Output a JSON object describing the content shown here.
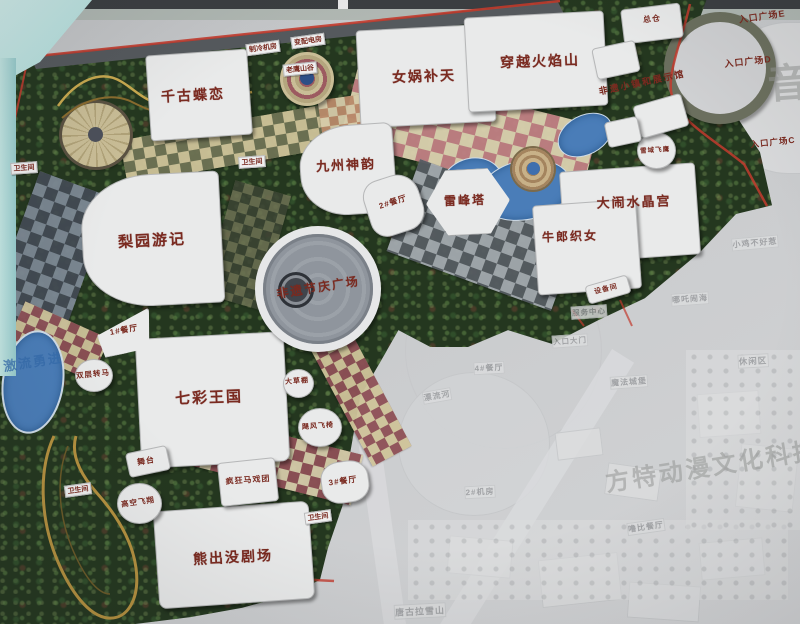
{
  "map": {
    "colors": {
      "label_red": "#7a2a20",
      "road_red": "#c23b2e",
      "water_blue": "#4a7db8",
      "sky_cyan": "#bfe4e1",
      "board_gray": "#c6c8ca",
      "ghost_text": "#96989b",
      "vegetation_green": "#24371f"
    },
    "labels": [
      {
        "name": "attraction-qiangu-dielian",
        "text": "千古蝶恋",
        "x": 193,
        "y": 95,
        "fs": 14,
        "rot": -3,
        "cls": "big"
      },
      {
        "name": "attraction-nvwa-butian",
        "text": "女娲补天",
        "x": 424,
        "y": 76,
        "fs": 14,
        "rot": -2,
        "cls": "big"
      },
      {
        "name": "attraction-chuanyue-huoyanshan",
        "text": "穿越火焰山",
        "x": 540,
        "y": 61,
        "fs": 14,
        "rot": -2,
        "cls": "big"
      },
      {
        "name": "attraction-jiuzhou-shenyun",
        "text": "九州神韵",
        "x": 346,
        "y": 164,
        "fs": 13,
        "rot": -3,
        "cls": "big"
      },
      {
        "name": "attraction-leifengta",
        "text": "雷峰塔",
        "x": 465,
        "y": 200,
        "fs": 12,
        "rot": -2,
        "cls": "big"
      },
      {
        "name": "attraction-danao-shuijinggong",
        "text": "大闹水晶宫",
        "x": 634,
        "y": 201,
        "fs": 13,
        "rot": -2,
        "cls": "big"
      },
      {
        "name": "attraction-niulang-zhinv",
        "text": "牛郎织女",
        "x": 570,
        "y": 236,
        "fs": 12,
        "rot": -2,
        "cls": "big"
      },
      {
        "name": "attraction-liyuan-youji",
        "text": "梨园游记",
        "x": 152,
        "y": 240,
        "fs": 15,
        "rot": -3,
        "cls": "big"
      },
      {
        "name": "plaza-feiyi-jieqing",
        "text": "非遗节庆广场",
        "x": 318,
        "y": 287,
        "fs": 12,
        "rot": -9,
        "cls": "big"
      },
      {
        "name": "attraction-qicai-wangguo",
        "text": "七彩王国",
        "x": 209,
        "y": 397,
        "fs": 15,
        "rot": -2,
        "cls": "big"
      },
      {
        "name": "attraction-xiongchumo-juchang",
        "text": "熊出没剧场",
        "x": 233,
        "y": 557,
        "fs": 14,
        "rot": -3,
        "cls": "big"
      },
      {
        "name": "attraction-fengkuang-maxituan",
        "text": "疯狂马戏团",
        "x": 248,
        "y": 480,
        "fs": 8,
        "rot": -4,
        "cls": "small"
      },
      {
        "name": "building-zongcang",
        "text": "总仓",
        "x": 652,
        "y": 19,
        "fs": 8,
        "rot": -6,
        "cls": "small"
      },
      {
        "name": "area-feiyi-town",
        "text": "非遗小镇和展示馆",
        "x": 642,
        "y": 82,
        "fs": 9,
        "rot": -12,
        "cls": "big"
      },
      {
        "name": "entrance-plaza-e",
        "text": "入口广场E",
        "x": 762,
        "y": 16,
        "fs": 9,
        "rot": -8,
        "cls": "small"
      },
      {
        "name": "entrance-plaza-d",
        "text": "入口广场D",
        "x": 748,
        "y": 61,
        "fs": 9,
        "rot": -6,
        "cls": "small"
      },
      {
        "name": "entrance-plaza-c",
        "text": "入口广场C",
        "x": 773,
        "y": 142,
        "fs": 8.5,
        "rot": -6,
        "cls": "small"
      },
      {
        "name": "restaurant-2",
        "text": "2#餐厅",
        "x": 393,
        "y": 202,
        "fs": 8,
        "rot": -18,
        "cls": "small"
      },
      {
        "name": "restaurant-1",
        "text": "1#餐厅",
        "x": 124,
        "y": 330,
        "fs": 8,
        "rot": -10,
        "cls": "small"
      },
      {
        "name": "restaurant-3",
        "text": "3#餐厅",
        "x": 343,
        "y": 481,
        "fs": 8,
        "rot": -8,
        "cls": "small"
      },
      {
        "name": "pavilion-dacaopeng",
        "text": "大草棚",
        "x": 297,
        "y": 381,
        "fs": 7,
        "rot": -4,
        "cls": "small"
      },
      {
        "name": "ride-jufeng-feiyi",
        "text": "飓风飞椅",
        "x": 318,
        "y": 426,
        "fs": 7,
        "rot": -4,
        "cls": "small"
      },
      {
        "name": "ride-gaokong-feixiang",
        "text": "高空飞翔",
        "x": 138,
        "y": 502,
        "fs": 7.5,
        "rot": -8,
        "cls": "small"
      },
      {
        "name": "ride-shuangceng-zhuanma",
        "text": "双层转马",
        "x": 93,
        "y": 374,
        "fs": 7.5,
        "rot": -6,
        "cls": "small"
      },
      {
        "name": "stage-wutai",
        "text": "舞台",
        "x": 146,
        "y": 461,
        "fs": 8,
        "rot": -10,
        "cls": "small"
      },
      {
        "name": "facility-zhileng-jifang",
        "text": "制冷机房",
        "x": 263,
        "y": 48,
        "fs": 7,
        "rot": -8,
        "cls": "chip"
      },
      {
        "name": "facility-bianpeidian",
        "text": "变配电房",
        "x": 308,
        "y": 41,
        "fs": 7,
        "rot": -8,
        "cls": "chip"
      },
      {
        "name": "ride-laoying-shangu",
        "text": "老鹰山谷",
        "x": 300,
        "y": 69,
        "fs": 7,
        "rot": -6,
        "cls": "chip"
      },
      {
        "name": "ride-xueyu-feiying",
        "text": "雪域飞鹰",
        "x": 655,
        "y": 149,
        "fs": 6.5,
        "rot": -4,
        "cls": "small"
      },
      {
        "name": "facility-shebeijian",
        "text": "设备间",
        "x": 606,
        "y": 289,
        "fs": 7,
        "rot": -14,
        "cls": "small"
      },
      {
        "name": "toilet-1",
        "text": "卫生间",
        "x": 24,
        "y": 168,
        "fs": 7,
        "rot": -4,
        "cls": "chip"
      },
      {
        "name": "toilet-2",
        "text": "卫生间",
        "x": 252,
        "y": 162,
        "fs": 7,
        "rot": -4,
        "cls": "chip"
      },
      {
        "name": "toilet-3",
        "text": "卫生间",
        "x": 78,
        "y": 490,
        "fs": 7,
        "rot": -8,
        "cls": "chip"
      },
      {
        "name": "toilet-4",
        "text": "卫生间",
        "x": 318,
        "y": 517,
        "fs": 7,
        "rot": -8,
        "cls": "chip"
      },
      {
        "name": "ride-jiliu-yongjin",
        "text": "激流勇进",
        "x": 33,
        "y": 361,
        "fs": 13,
        "rot": -9,
        "cls": "blue"
      },
      {
        "name": "watermark-yin",
        "text": "音",
        "x": 789,
        "y": 80,
        "fs": 40,
        "rot": -4,
        "cls": "wm"
      },
      {
        "name": "watermark-fangte-donman",
        "text": "方特动漫文化科技",
        "x": 712,
        "y": 464,
        "fs": 24,
        "rot": -9,
        "cls": "wm"
      },
      {
        "name": "ghost-xiaoji-buhaore",
        "text": "小鸡不好惹",
        "x": 755,
        "y": 243,
        "fs": 8,
        "rot": -5,
        "cls": "ghost"
      },
      {
        "name": "ghost-nezha-naohai",
        "text": "哪吒闹海",
        "x": 690,
        "y": 299,
        "fs": 8,
        "rot": -4,
        "cls": "ghost"
      },
      {
        "name": "ghost-xiuxianqu",
        "text": "休闲区",
        "x": 753,
        "y": 361,
        "fs": 8.5,
        "rot": -3,
        "cls": "ghost"
      },
      {
        "name": "ghost-mofa-chengbao",
        "text": "魔法城堡",
        "x": 629,
        "y": 382,
        "fs": 8,
        "rot": -4,
        "cls": "ghost"
      },
      {
        "name": "ghost-fuwu-zhongxin",
        "text": "服务中心",
        "x": 589,
        "y": 312,
        "fs": 7.5,
        "rot": -4,
        "cls": "ghost"
      },
      {
        "name": "ghost-rukou-damen",
        "text": "入口大门",
        "x": 570,
        "y": 341,
        "fs": 7.5,
        "rot": -4,
        "cls": "ghost"
      },
      {
        "name": "ghost-jifang-2",
        "text": "2#机房",
        "x": 480,
        "y": 492,
        "fs": 8,
        "rot": -3,
        "cls": "ghost"
      },
      {
        "name": "ghost-canting-4",
        "text": "4#餐厅",
        "x": 489,
        "y": 368,
        "fs": 8,
        "rot": -3,
        "cls": "ghost"
      },
      {
        "name": "ghost-lubi-canting",
        "text": "噜比餐厅",
        "x": 646,
        "y": 527,
        "fs": 8,
        "rot": -8,
        "cls": "ghost"
      },
      {
        "name": "ghost-tanggula-xueshan",
        "text": "唐古拉雪山",
        "x": 420,
        "y": 611,
        "fs": 9,
        "rot": -3,
        "cls": "ghost"
      },
      {
        "name": "ghost-piaoliuhe",
        "text": "漂流河",
        "x": 437,
        "y": 396,
        "fs": 8,
        "rot": -10,
        "cls": "ghost"
      }
    ]
  }
}
